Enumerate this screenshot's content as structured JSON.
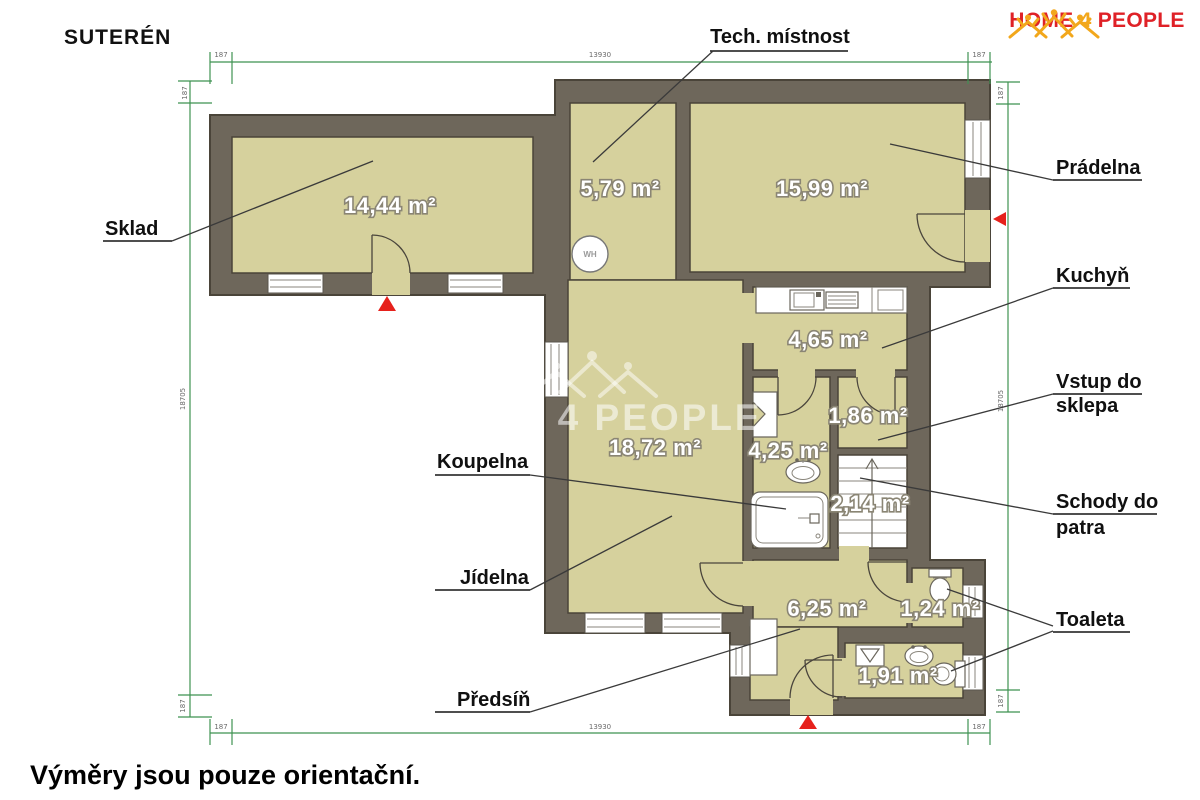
{
  "page": {
    "title": "SUTERÉN",
    "footer_note": "Výměry jsou pouze orientační."
  },
  "logo": {
    "home": "HOME",
    "four": "4",
    "people": "PEOPLE",
    "text_color": "#df2127",
    "accent_color": "#f2a71b"
  },
  "watermark": {
    "text": "HOME 4 PEOPLE"
  },
  "plan": {
    "colors": {
      "wall": "#6e675b",
      "room_fill": "#d6d19d",
      "outline": "#4a4439",
      "dimension_green": "#3f9252",
      "marker_red": "#e6211c",
      "area_text": "#ffffff",
      "area_text_outline": "#8a8574",
      "label_text": "#101010"
    },
    "rooms": [
      {
        "id": "sklad",
        "label": "Sklad",
        "area": "14,44 m²"
      },
      {
        "id": "tech",
        "label": "Tech. místnost",
        "area": "5,79 m²"
      },
      {
        "id": "pradelna",
        "label": "Prádelna",
        "area": "15,99 m²"
      },
      {
        "id": "kuchyn",
        "label": "Kuchyň",
        "area": "4,65 m²"
      },
      {
        "id": "vstup",
        "label": "Vstup do sklepa",
        "area": "1,86 m²"
      },
      {
        "id": "jidelna",
        "label": "Jídelna",
        "area": "18,72 m²"
      },
      {
        "id": "koupelna",
        "label": "Koupelna",
        "area": "4,25 m²"
      },
      {
        "id": "schody",
        "label": "Schody do patra",
        "area": "2,14 m²"
      },
      {
        "id": "predsin",
        "label": "Předsíň",
        "area": "6,25 m²"
      },
      {
        "id": "toaleta1",
        "label": "Toaleta",
        "area": "1,24 m²"
      },
      {
        "id": "toaleta2",
        "label": "Toaleta",
        "area": "1,91 m²"
      }
    ],
    "callout_lines": {
      "vstup_1": "Vstup do",
      "vstup_2": "sklepa",
      "schody_1": "Schody do",
      "schody_2": "patra"
    },
    "fixtures": {
      "water_heater": "WH"
    },
    "dimensions": {
      "small": "187",
      "top_main": "13930",
      "side_main": "18705",
      "bottom_main": "13930"
    }
  }
}
